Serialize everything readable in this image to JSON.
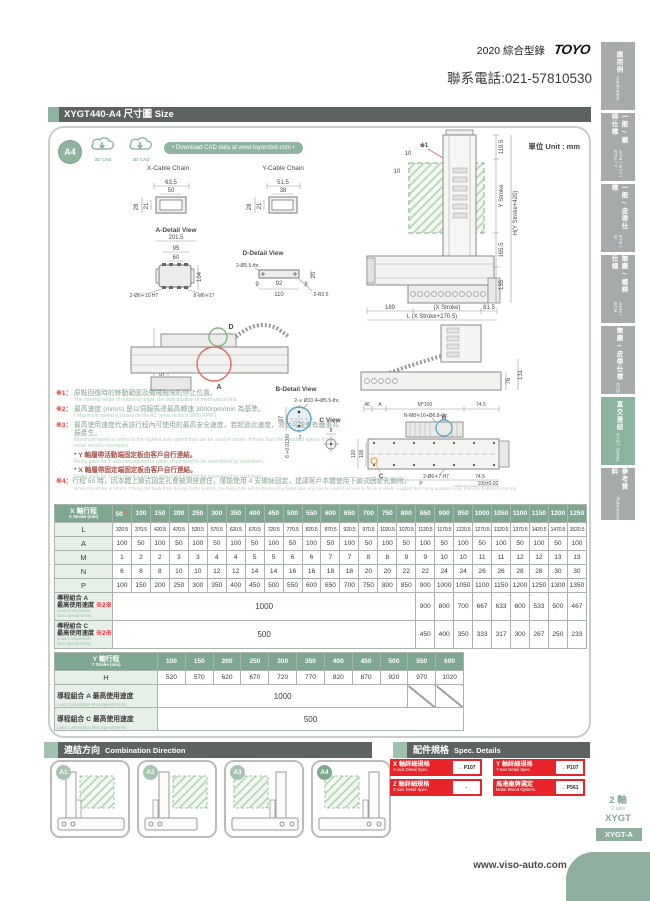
{
  "header": {
    "catalog": "2020 綜合型錄",
    "logo": "TOYO",
    "phone": "聯系電話:021-57810530"
  },
  "sidebar": {
    "tabs": [
      {
        "zh": "應用例",
        "en": "Application"
      },
      {
        "zh": "一般 / 螺桿仕樣",
        "en": "GTH / GTY / ETH / Y"
      },
      {
        "zh": "一般 / 皮帶仕樣",
        "en": "ETB / M"
      },
      {
        "zh": "無塵 / 螺桿仕樣",
        "en": "GCH / ECH"
      },
      {
        "zh": "無塵 / 皮帶仕樣",
        "en": "ECB"
      },
      {
        "zh": "直交連結",
        "en": "XYGT Series"
      },
      {
        "zh": "參考資料",
        "en": "Reference"
      }
    ]
  },
  "title_bar": {
    "text": "XYGT440-A4 尺寸圖 Size"
  },
  "cad": {
    "badge": "A4",
    "cad2d": "2D CAD",
    "cad3d": "3D CAD",
    "download": "• Download CAD data at www.toyorobot.com •",
    "unit": "單位 Unit : mm"
  },
  "drawings": {
    "x_cable": {
      "title": "X-Cable Chain",
      "w_outer": "63.5",
      "w_inner": "50",
      "h_outer": "28",
      "h_inner": "21"
    },
    "y_cable": {
      "title": "Y-Cable Chain",
      "w_outer": "51.5",
      "w_inner": "38",
      "h_outer": "28",
      "h_inner": "21"
    },
    "a_detail": {
      "title": "A-Detail View",
      "w_total": "201.5",
      "w_mid": "95",
      "w_inner": "60",
      "h": "104",
      "callout_holes": "2-Ø6∓10 H7",
      "callout_screws": "8-M6∓17"
    },
    "d_detail": {
      "title": "D-Detail View",
      "callout_holes": "2-Ø5.5-thr.",
      "h": "20",
      "w_left": "9",
      "w_mid": "92",
      "w_right": "8",
      "w_total": "110",
      "callout_radius": "2-R2.5"
    },
    "elevation": {
      "note_ref": "※1",
      "offset_top": "10",
      "offset_side": "10",
      "dim_top": "119.5",
      "dim_y_stroke": "Y Stroke",
      "dim_height": "H(Y Stroke+420)",
      "dim_mid": "165.5",
      "dim_base": "135",
      "dim_left": "189",
      "dim_x_stroke": "(X Stroke)",
      "dim_right": "81.5",
      "dim_length": "L (X Stroke+270.5)"
    },
    "side_view": {
      "dim_h1": "324.5",
      "dim_h2": "156.5",
      "marker_d": "D",
      "marker_a": "A"
    },
    "side_view2": {
      "dim_h1": "76",
      "dim_h2": "131"
    },
    "b_detail": {
      "title": "B-Detail View",
      "callout": "2-∨ Ø10.4+Ø5.5-thr.",
      "dim1": "37",
      "dim2": "6 +0.012/0",
      "dim3": "7"
    },
    "c_view": {
      "title": "C View",
      "dim1": "8"
    },
    "plan": {
      "dim_t1": "46",
      "dim_t2": "A",
      "dim_t3": "M*100",
      "dim_t4": "74.5",
      "callout_screws": "N-M8∓16+Ø6.8-thr.",
      "marker_b": "B",
      "dim_l1": "120",
      "dim_l2": "108",
      "marker_c": "C",
      "callout_holes": "2-Ø6∓7 H7",
      "dim_b1": "P",
      "dim_b2": "74.5",
      "dim_b3": "100±0.02"
    }
  },
  "notes": [
    {
      "ref": "※1：",
      "zh": "原點回復時的移動範圍及機械極限的停止位置。",
      "en": "The moving range of returning origin, the stop position of mechanical limit."
    },
    {
      "ref": "※2：",
      "zh": "最高速度 (mm/s) 是以伺服馬達最高轉速 3000rpm/min 為基準。",
      "en": "( Maximum speed is based on the AC servo motor's 3000 RPM )"
    },
    {
      "ref": "※3：",
      "zh": "最高使用速度代表該行程內可使用的最高安全速度，若超過此速度，滑台可能會有嚴重共振產生。",
      "en": "Maximum speed is refers to the highest safe speed that can be used in stroke, if more than the standard speed, it may occur serious resonance."
    }
  ],
  "star_notes": [
    {
      "zh": "* Y 軸履帶活動端固定板由客戶自行連結。",
      "en": "Fixing plate for Y axis moving end of cable chain need to be assembled by customers."
    },
    {
      "zh": "* X 軸履帶固定端固定板由客戶自行連結。",
      "en": "Fixing plate for X axis moving end of cable chain need to be assembled by customers."
    }
  ],
  "note4": {
    "ref": "※4：",
    "zh": "行程 50 時，因本體上鎖式固定孔會被滑座遮住，僅能使用 4 支螺絲固定，建議客戶本體使用下鎖式固定孔鎖附。",
    "en": "When the stroke is 50mm, if fixing the body from the top to the bottom, the fixing hole will be blocked by slider and only can be uses 4 screws to fix as a result, suggest that fixing actuator body from the bottom to the top."
  },
  "x_table": {
    "header_zh": "X 軸行程",
    "header_en": "X Stroke (mm)",
    "first_note": "※4",
    "strokes": [
      "50",
      "100",
      "150",
      "200",
      "250",
      "300",
      "350",
      "400",
      "450",
      "500",
      "550",
      "600",
      "650",
      "700",
      "750",
      "800",
      "850",
      "900",
      "950",
      "1000",
      "1050",
      "1100",
      "1150",
      "1200",
      "1250"
    ],
    "rows": [
      {
        "label": "L",
        "values": [
          "320.5",
          "370.5",
          "420.5",
          "470.5",
          "520.5",
          "570.5",
          "620.5",
          "670.5",
          "720.5",
          "770.5",
          "820.5",
          "870.5",
          "920.5",
          "970.5",
          "1020.5",
          "1070.5",
          "1120.5",
          "1170.5",
          "1220.5",
          "1270.5",
          "1320.5",
          "1370.5",
          "1420.5",
          "1470.5",
          "1520.5"
        ]
      },
      {
        "label": "A",
        "values": [
          "100",
          "50",
          "100",
          "50",
          "100",
          "50",
          "100",
          "50",
          "100",
          "50",
          "100",
          "50",
          "100",
          "50",
          "100",
          "50",
          "100",
          "50",
          "100",
          "50",
          "100",
          "50",
          "100",
          "50",
          "100"
        ]
      },
      {
        "label": "M",
        "values": [
          "1",
          "2",
          "2",
          "3",
          "3",
          "4",
          "4",
          "5",
          "5",
          "6",
          "6",
          "7",
          "7",
          "8",
          "8",
          "9",
          "9",
          "10",
          "10",
          "11",
          "11",
          "12",
          "12",
          "13",
          "13"
        ]
      },
      {
        "label": "N",
        "values": [
          "6",
          "8",
          "8",
          "10",
          "10",
          "12",
          "12",
          "14",
          "14",
          "16",
          "16",
          "18",
          "18",
          "20",
          "20",
          "22",
          "22",
          "24",
          "24",
          "26",
          "26",
          "28",
          "28",
          "30",
          "30"
        ]
      },
      {
        "label": "P",
        "values": [
          "100",
          "150",
          "200",
          "250",
          "300",
          "350",
          "400",
          "450",
          "500",
          "550",
          "600",
          "650",
          "700",
          "750",
          "800",
          "850",
          "900",
          "1000",
          "1050",
          "1100",
          "1150",
          "1200",
          "1250",
          "1300",
          "1350"
        ]
      }
    ],
    "speed_rows": [
      {
        "zh1": "導程組合 A",
        "zh2": "最高使用速度",
        "note": "※2※3",
        "en1": "Lead Composition",
        "en2": "Max.Speed(mm/s)",
        "merged": "1000",
        "merged_cols": 16,
        "tail": [
          "900",
          "800",
          "700",
          "667",
          "633",
          "600",
          "533",
          "500",
          "467"
        ]
      },
      {
        "zh1": "導程組合 C",
        "zh2": "最高使用速度",
        "note": "※2※3",
        "en1": "Lead Composition",
        "en2": "Max.Speed(mm/s)",
        "merged": "500",
        "merged_cols": 16,
        "tail": [
          "450",
          "400",
          "350",
          "333",
          "317",
          "300",
          "267",
          "250",
          "233"
        ]
      }
    ]
  },
  "y_table": {
    "header_zh": "Y 軸行程",
    "header_en": "Y Stroke (mm)",
    "strokes": [
      "100",
      "150",
      "200",
      "250",
      "300",
      "350",
      "400",
      "450",
      "500",
      "550",
      "600"
    ],
    "h_label": "H",
    "h_values": [
      "520",
      "570",
      "620",
      "670",
      "720",
      "770",
      "820",
      "870",
      "920",
      "970",
      "1020"
    ],
    "speed_rows": [
      {
        "zh": "導程組合 A 最高使用速度",
        "en": "Lead Composition Max.Speed(mm/s)",
        "merged": "1000",
        "merged_cols": 9,
        "slash_cols": 2
      },
      {
        "zh": "導程組合 C 最高使用速度",
        "en": "Lead Composition Max.Speed(mm/s)",
        "merged": "500",
        "merged_cols": 11,
        "slash_cols": 0
      }
    ]
  },
  "combination": {
    "title_zh": "連結方向",
    "title_en": "Combination Direction",
    "cards": [
      "A1",
      "A2",
      "A3",
      "A4"
    ]
  },
  "spec_details": {
    "title_zh": "配件規格",
    "title_en": "Spec. Details",
    "buttons": [
      {
        "zh": "X 軸詳細規格",
        "en": "X-axis Detail Spec.",
        "link": "→ P107"
      },
      {
        "zh": "Y 軸詳細規格",
        "en": "Y-axis Detail Spec.",
        "link": "→ P107"
      },
      {
        "zh": "Z 軸詳細規格",
        "en": "Z-axis Detail Spec.",
        "link": "-"
      },
      {
        "zh": "馬達廠牌選定",
        "en": "Motor Brand Options.",
        "link": "→ P561"
      }
    ]
  },
  "footer": {
    "axis_zh": "2 軸",
    "axis_en": "2 axis",
    "series": "XYGT",
    "model": "XYGT-A",
    "url": "www.viso-auto.com"
  }
}
